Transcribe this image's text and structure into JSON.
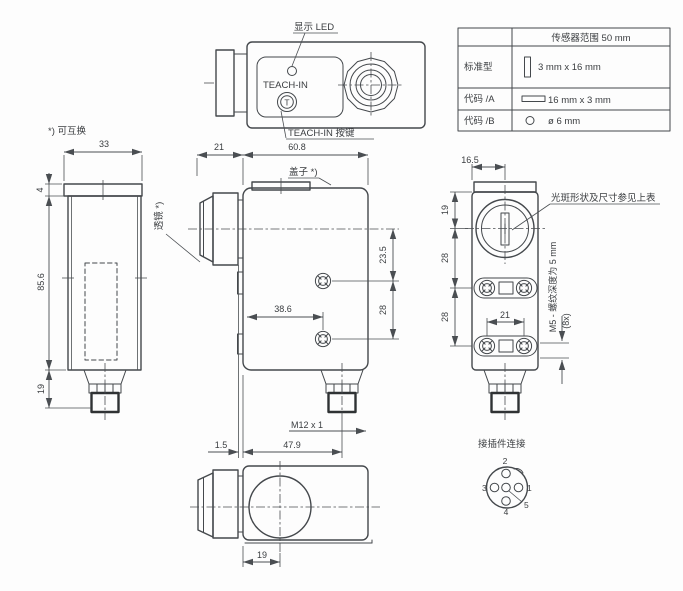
{
  "top_view": {
    "led_label": "显示 LED",
    "panel_label": "TEACH-IN",
    "button_glyph": "T",
    "button_label": "TEACH-IN 按键"
  },
  "table": {
    "header": "传感器范围 50 mm",
    "rows": [
      {
        "label": "标准型",
        "icon": "slit-vertical-icon",
        "value": "3 mm x 16 mm"
      },
      {
        "label": "代码 /A",
        "icon": "slit-horizontal-icon",
        "value": "16 mm x 3 mm"
      },
      {
        "label": "代码 /B",
        "icon": "round-spot-icon",
        "value": "ø 6 mm"
      }
    ]
  },
  "notes": {
    "interchangeable": "*) 可互换",
    "lens": "透镜 *)",
    "cover": "盖子 *)",
    "spot_note": "光斑形状及尺寸参见上表",
    "thread_note": "M5 - 螺纹深度为 5 mm",
    "thread_count": "(8x)",
    "connector_note": "接插件连接",
    "m12_thread": "M12 x 1"
  },
  "dims": {
    "left": {
      "w": "33",
      "cap": "4",
      "h": "85.6",
      "plug": "19"
    },
    "front": {
      "lens": "21",
      "w": "60.8",
      "d1": "23.5",
      "d2": "28",
      "d3": "38.6",
      "off": "1.5",
      "plug_x": "47.9"
    },
    "side": {
      "w": "16.5",
      "d1": "19",
      "d2": "28",
      "d3": "28",
      "holes": "21"
    },
    "bottom": {
      "lens_off": "19"
    },
    "pins": {
      "p1": "1",
      "p2": "2",
      "p3": "3",
      "p4": "4",
      "p5": "5"
    }
  },
  "colors": {
    "line": "#44484c",
    "text": "#3a3d40",
    "knurl": "#232527",
    "background": "#fdfdfd"
  }
}
